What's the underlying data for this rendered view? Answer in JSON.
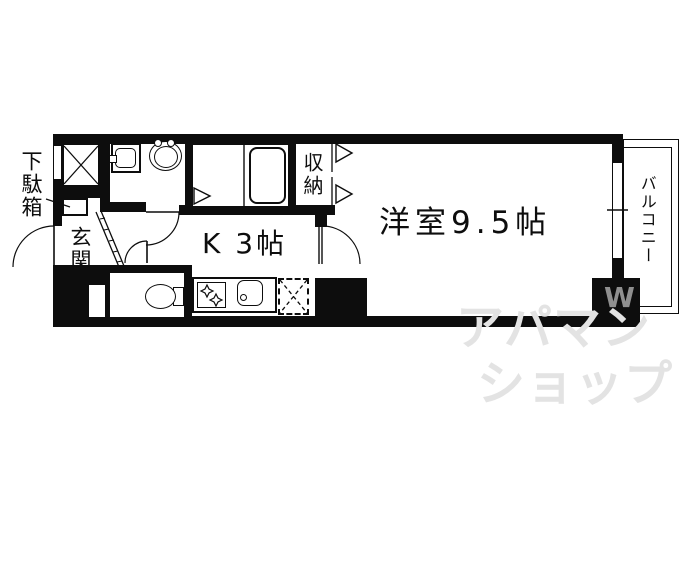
{
  "floor_plan": {
    "labels": {
      "shoe_cabinet": "下駄箱",
      "entrance": "玄関",
      "kitchen": "K 3帖",
      "western_room": "洋室9.5帖",
      "closet": "収納",
      "balcony": "バルコニー"
    },
    "rooms": [
      {
        "name": "玄関",
        "type": "entrance"
      },
      {
        "name": "K 3帖",
        "type": "kitchen",
        "size_jo": "3"
      },
      {
        "name": "洋室9.5帖",
        "type": "western_room",
        "size_jo": "9.5"
      },
      {
        "name": "収納",
        "type": "closet"
      },
      {
        "name": "バルコニー",
        "type": "balcony"
      },
      {
        "name": "下駄箱",
        "type": "shoe_cabinet"
      }
    ],
    "watermark": {
      "line1": "アパマン",
      "line2": "ショップ",
      "logo_mark": "W"
    },
    "colors": {
      "line": "#0d0d0d",
      "background": "#ffffff",
      "watermark_text": "#e3e3e3",
      "watermark_logo": "#8f8f8f"
    }
  }
}
